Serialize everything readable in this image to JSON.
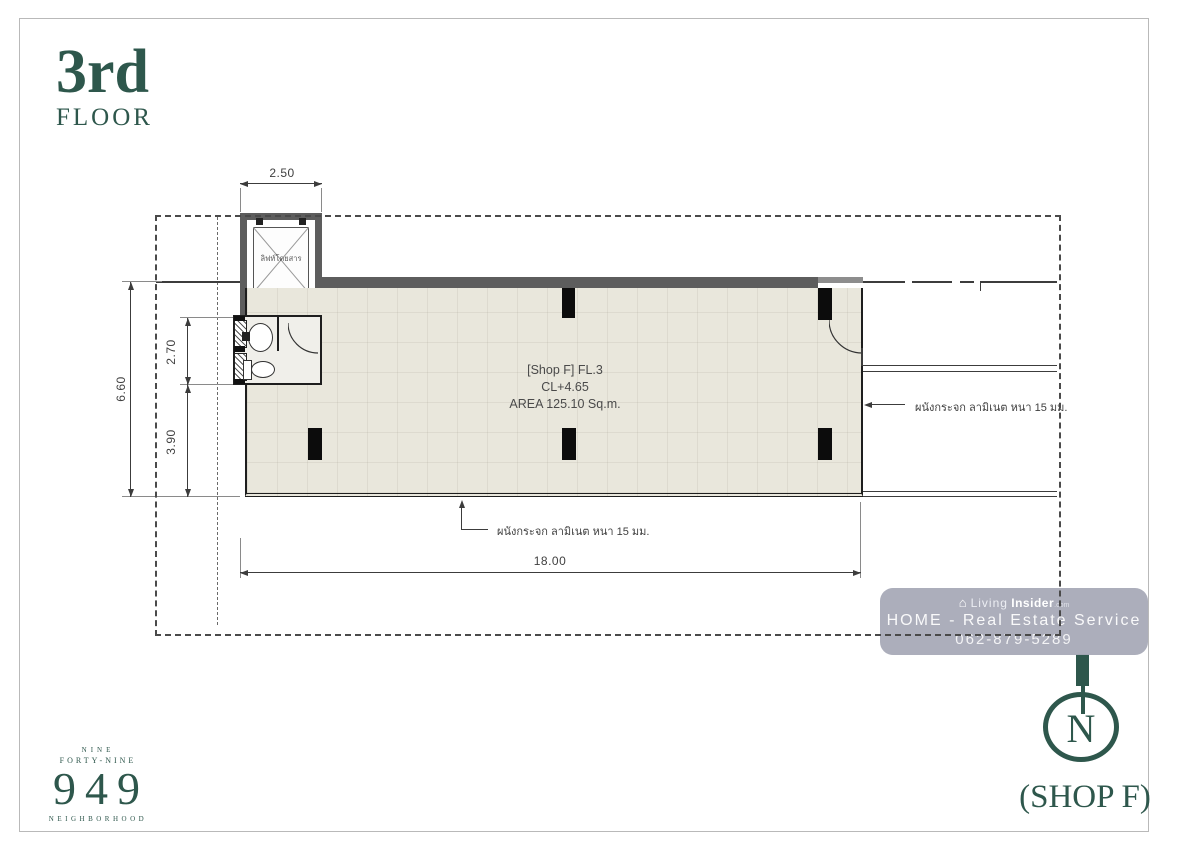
{
  "title": {
    "floor_number": "3rd",
    "floor_word": "FLOOR"
  },
  "plan": {
    "elevator": {
      "car_label": "ลิฟท์โดยสาร",
      "spec": [
        "PARKING",
        "NEXIEZ",
        "P11",
        "MITSUBISHI"
      ]
    },
    "unit": {
      "name": "[Shop F] FL.3",
      "ceiling": "CL+4.65",
      "area": "AREA 125.10 Sq.m."
    },
    "dims": {
      "top": "2.50",
      "left_total": "6.60",
      "left_upper": "2.70",
      "left_lower": "3.90",
      "bottom": "18.00"
    },
    "annotations": {
      "right_wall": "ผนังกระจก ลามิเนต หนา 15 มม.",
      "bottom_wall": "ผนังกระจก ลามิเนต หนา 15 มม."
    }
  },
  "watermark": {
    "icon": "⌂",
    "brand_light": "Living",
    "brand_bold": "Insider",
    "brand_tld": ".com",
    "service_line": "HOME - Real Estate Service",
    "phone": "062-879-5289"
  },
  "compass": {
    "north_letter": "N"
  },
  "shop_caption": "(SHOP F)",
  "brand_logo": {
    "top_line": "NINE",
    "second_line": "FORTY-NINE",
    "number": "949",
    "bottom_line": "NEIGHBORHOOD"
  },
  "colors": {
    "brand_green": "#2e574c",
    "wall_gray": "#5d5d5d",
    "floor_beige": "#e9e7dc",
    "watermark_bg": "#a8aab7",
    "line_dark": "#3c3c3c"
  }
}
